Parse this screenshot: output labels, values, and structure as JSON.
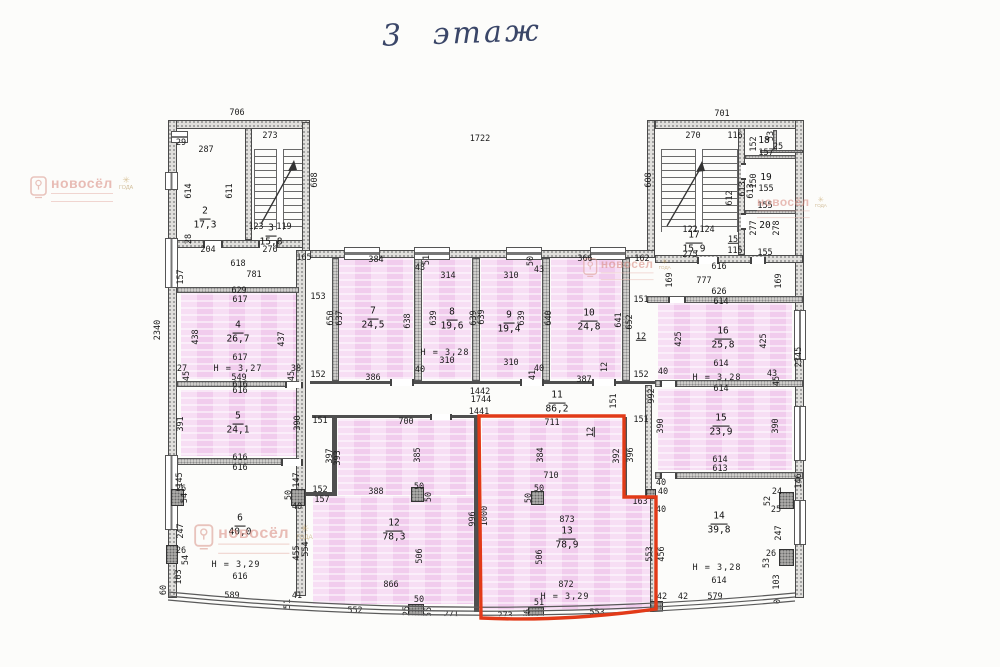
{
  "page": {
    "title_handwritten": "3 этаж"
  },
  "watermark": {
    "brand": "новосёл",
    "badge": "ГОДА"
  },
  "rooms": [
    {
      "num": "2",
      "area": "17,3",
      "x": 205,
      "y": 219
    },
    {
      "num": "3",
      "area": "15,8",
      "x": 271,
      "y": 236
    },
    {
      "num": "4",
      "area": "26,7",
      "x": 238,
      "y": 333
    },
    {
      "num": "5",
      "area": "24,1",
      "x": 238,
      "y": 424
    },
    {
      "num": "6",
      "area": "40,0",
      "x": 240,
      "y": 526
    },
    {
      "num": "7",
      "area": "24,5",
      "x": 373,
      "y": 319
    },
    {
      "num": "8",
      "area": "19,6",
      "x": 452,
      "y": 320
    },
    {
      "num": "9",
      "area": "19,4",
      "x": 509,
      "y": 323
    },
    {
      "num": "10",
      "area": "24,8",
      "x": 589,
      "y": 321
    },
    {
      "num": "11",
      "area": "86,2",
      "x": 557,
      "y": 403
    },
    {
      "num": "12",
      "area": "78,3",
      "x": 394,
      "y": 531
    },
    {
      "num": "13",
      "area": "78,9",
      "x": 567,
      "y": 539
    },
    {
      "num": "14",
      "area": "39,8",
      "x": 719,
      "y": 524
    },
    {
      "num": "15",
      "area": "23,9",
      "x": 721,
      "y": 426
    },
    {
      "num": "16",
      "area": "25,8",
      "x": 723,
      "y": 339
    },
    {
      "num": "17",
      "area": "15,9",
      "x": 694,
      "y": 243
    },
    {
      "num": "18",
      "area": "",
      "x": 764,
      "y": 142
    },
    {
      "num": "19",
      "area": "",
      "x": 766,
      "y": 179
    },
    {
      "num": "20",
      "area": "",
      "x": 765,
      "y": 227
    }
  ],
  "heights": [
    {
      "t": "H = 3,27",
      "x": 238,
      "y": 369
    },
    {
      "t": "H = 3,29",
      "x": 236,
      "y": 565
    },
    {
      "t": "H = 3,28",
      "x": 445,
      "y": 353
    },
    {
      "t": "H = 3,28",
      "x": 717,
      "y": 378
    },
    {
      "t": "H = 3,29",
      "x": 565,
      "y": 597
    },
    {
      "t": "H = 3,28",
      "x": 717,
      "y": 568
    }
  ],
  "dims": [
    {
      "t": "706",
      "x": 237,
      "y": 113
    },
    {
      "t": "273",
      "x": 270,
      "y": 136
    },
    {
      "t": "701",
      "x": 722,
      "y": 114
    },
    {
      "t": "270",
      "x": 693,
      "y": 136
    },
    {
      "t": "116",
      "x": 735,
      "y": 136
    },
    {
      "t": "1722",
      "x": 480,
      "y": 139
    },
    {
      "t": "608",
      "x": 315,
      "y": 180,
      "r": 1
    },
    {
      "t": "608",
      "x": 649,
      "y": 180,
      "r": 1
    },
    {
      "t": "2340",
      "x": 158,
      "y": 330,
      "r": 1
    },
    {
      "t": "2345",
      "x": 799,
      "y": 357,
      "r": 1
    },
    {
      "t": "29",
      "x": 181,
      "y": 143
    },
    {
      "t": "287",
      "x": 206,
      "y": 150
    },
    {
      "t": "614",
      "x": 189,
      "y": 191,
      "r": 1
    },
    {
      "t": "611",
      "x": 230,
      "y": 191,
      "r": 1
    },
    {
      "t": "123",
      "x": 256,
      "y": 227
    },
    {
      "t": "119",
      "x": 284,
      "y": 227
    },
    {
      "t": "28",
      "x": 189,
      "y": 239,
      "r": 1
    },
    {
      "t": "204",
      "x": 208,
      "y": 250
    },
    {
      "t": "276",
      "x": 270,
      "y": 250
    },
    {
      "t": "165",
      "x": 304,
      "y": 258
    },
    {
      "t": "618",
      "x": 238,
      "y": 264
    },
    {
      "t": "781",
      "x": 254,
      "y": 275
    },
    {
      "t": "157",
      "x": 181,
      "y": 277,
      "r": 1
    },
    {
      "t": "629",
      "x": 239,
      "y": 291
    },
    {
      "t": "617",
      "x": 240,
      "y": 300
    },
    {
      "t": "153",
      "x": 318,
      "y": 297
    },
    {
      "t": "438",
      "x": 196,
      "y": 337,
      "r": 1
    },
    {
      "t": "437",
      "x": 282,
      "y": 339,
      "r": 1
    },
    {
      "t": "617",
      "x": 240,
      "y": 358
    },
    {
      "t": "27",
      "x": 182,
      "y": 369
    },
    {
      "t": "45",
      "x": 187,
      "y": 376,
      "r": 1
    },
    {
      "t": "549",
      "x": 239,
      "y": 378
    },
    {
      "t": "38",
      "x": 296,
      "y": 369
    },
    {
      "t": "45",
      "x": 292,
      "y": 376,
      "r": 1
    },
    {
      "t": "616",
      "x": 240,
      "y": 385
    },
    {
      "t": "616",
      "x": 240,
      "y": 391
    },
    {
      "t": "391",
      "x": 181,
      "y": 424,
      "r": 1
    },
    {
      "t": "390",
      "x": 298,
      "y": 423,
      "r": 1
    },
    {
      "t": "616",
      "x": 240,
      "y": 458
    },
    {
      "t": "616",
      "x": 240,
      "y": 468
    },
    {
      "t": "145",
      "x": 180,
      "y": 480,
      "r": 1
    },
    {
      "t": "147",
      "x": 297,
      "y": 480,
      "r": 1
    },
    {
      "t": "26",
      "x": 181,
      "y": 489
    },
    {
      "t": "54",
      "x": 185,
      "y": 498,
      "r": 1
    },
    {
      "t": "50",
      "x": 289,
      "y": 495,
      "r": 1
    },
    {
      "t": "40",
      "x": 297,
      "y": 507
    },
    {
      "t": "247",
      "x": 181,
      "y": 531,
      "r": 1
    },
    {
      "t": "455",
      "x": 297,
      "y": 553,
      "r": 1
    },
    {
      "t": "554",
      "x": 306,
      "y": 549,
      "r": 1
    },
    {
      "t": "26",
      "x": 181,
      "y": 551
    },
    {
      "t": "54",
      "x": 186,
      "y": 560,
      "r": 1
    },
    {
      "t": "103",
      "x": 179,
      "y": 577,
      "r": 1
    },
    {
      "t": "616",
      "x": 240,
      "y": 577
    },
    {
      "t": "589",
      "x": 232,
      "y": 596
    },
    {
      "t": "60",
      "x": 164,
      "y": 590,
      "r": 1
    },
    {
      "t": "41",
      "x": 297,
      "y": 596
    },
    {
      "t": "51",
      "x": 288,
      "y": 604,
      "r": 1
    },
    {
      "t": "152",
      "x": 318,
      "y": 375
    },
    {
      "t": "384",
      "x": 376,
      "y": 260
    },
    {
      "t": "43",
      "x": 420,
      "y": 268
    },
    {
      "t": "51",
      "x": 427,
      "y": 260,
      "r": 1
    },
    {
      "t": "314",
      "x": 448,
      "y": 276
    },
    {
      "t": "50",
      "x": 531,
      "y": 261,
      "r": 1
    },
    {
      "t": "43",
      "x": 539,
      "y": 270
    },
    {
      "t": "310",
      "x": 511,
      "y": 276
    },
    {
      "t": "366",
      "x": 585,
      "y": 259
    },
    {
      "t": "162",
      "x": 642,
      "y": 259
    },
    {
      "t": "650",
      "x": 331,
      "y": 318,
      "r": 1
    },
    {
      "t": "637",
      "x": 340,
      "y": 318,
      "r": 1
    },
    {
      "t": "638",
      "x": 408,
      "y": 321,
      "r": 1
    },
    {
      "t": "639",
      "x": 434,
      "y": 318,
      "r": 1
    },
    {
      "t": "639",
      "x": 474,
      "y": 318,
      "r": 1
    },
    {
      "t": "639",
      "x": 482,
      "y": 317,
      "r": 1
    },
    {
      "t": "639",
      "x": 522,
      "y": 318,
      "r": 1
    },
    {
      "t": "640",
      "x": 549,
      "y": 318,
      "r": 1
    },
    {
      "t": "641",
      "x": 619,
      "y": 320,
      "r": 1
    },
    {
      "t": "652",
      "x": 630,
      "y": 322,
      "r": 1
    },
    {
      "t": "151",
      "x": 641,
      "y": 300
    },
    {
      "t": "12",
      "x": 641,
      "y": 337,
      "u": 1
    },
    {
      "t": "310",
      "x": 447,
      "y": 361
    },
    {
      "t": "310",
      "x": 511,
      "y": 363
    },
    {
      "t": "386",
      "x": 373,
      "y": 378
    },
    {
      "t": "40",
      "x": 420,
      "y": 370
    },
    {
      "t": "40",
      "x": 539,
      "y": 369
    },
    {
      "t": "41",
      "x": 533,
      "y": 375,
      "r": 1
    },
    {
      "t": "387",
      "x": 584,
      "y": 380
    },
    {
      "t": "12",
      "x": 605,
      "y": 367,
      "r": 1
    },
    {
      "t": "152",
      "x": 641,
      "y": 375
    },
    {
      "t": "1442",
      "x": 480,
      "y": 392
    },
    {
      "t": "1744",
      "x": 481,
      "y": 400
    },
    {
      "t": "1441",
      "x": 479,
      "y": 412
    },
    {
      "t": "151",
      "x": 614,
      "y": 401,
      "r": 1
    },
    {
      "t": "992",
      "x": 652,
      "y": 396,
      "r": 1
    },
    {
      "t": "151",
      "x": 320,
      "y": 421
    },
    {
      "t": "700",
      "x": 406,
      "y": 422
    },
    {
      "t": "397",
      "x": 330,
      "y": 456,
      "r": 1
    },
    {
      "t": "393",
      "x": 338,
      "y": 458,
      "r": 1
    },
    {
      "t": "385",
      "x": 418,
      "y": 455,
      "r": 1
    },
    {
      "t": "152",
      "x": 320,
      "y": 490
    },
    {
      "t": "157",
      "x": 322,
      "y": 500
    },
    {
      "t": "388",
      "x": 376,
      "y": 492
    },
    {
      "t": "50",
      "x": 419,
      "y": 487
    },
    {
      "t": "50",
      "x": 429,
      "y": 497,
      "r": 1
    },
    {
      "t": "506",
      "x": 420,
      "y": 556,
      "r": 1
    },
    {
      "t": "866",
      "x": 391,
      "y": 585
    },
    {
      "t": "552",
      "x": 355,
      "y": 611
    },
    {
      "t": "50",
      "x": 419,
      "y": 600
    },
    {
      "t": "25",
      "x": 407,
      "y": 611,
      "r": 1
    },
    {
      "t": "55",
      "x": 429,
      "y": 612,
      "r": 1
    },
    {
      "t": "271",
      "x": 451,
      "y": 615
    },
    {
      "t": "996",
      "x": 473,
      "y": 519,
      "r": 1
    },
    {
      "t": "1000",
      "x": 485,
      "y": 516,
      "r": 1
    },
    {
      "t": "711",
      "x": 552,
      "y": 423
    },
    {
      "t": "12",
      "x": 591,
      "y": 432,
      "r": 1,
      "u": 1
    },
    {
      "t": "151",
      "x": 641,
      "y": 420
    },
    {
      "t": "384",
      "x": 541,
      "y": 455,
      "r": 1
    },
    {
      "t": "392",
      "x": 617,
      "y": 456,
      "r": 1
    },
    {
      "t": "396",
      "x": 631,
      "y": 455,
      "r": 1
    },
    {
      "t": "710",
      "x": 551,
      "y": 476
    },
    {
      "t": "50",
      "x": 539,
      "y": 489
    },
    {
      "t": "50",
      "x": 529,
      "y": 498,
      "r": 1
    },
    {
      "t": "163",
      "x": 640,
      "y": 502
    },
    {
      "t": "40",
      "x": 663,
      "y": 492
    },
    {
      "t": "40",
      "x": 661,
      "y": 510
    },
    {
      "t": "873",
      "x": 567,
      "y": 520
    },
    {
      "t": "506",
      "x": 540,
      "y": 557,
      "r": 1
    },
    {
      "t": "553",
      "x": 650,
      "y": 554,
      "r": 1
    },
    {
      "t": "456",
      "x": 662,
      "y": 554,
      "r": 1
    },
    {
      "t": "872",
      "x": 566,
      "y": 585
    },
    {
      "t": "273",
      "x": 505,
      "y": 616
    },
    {
      "t": "51",
      "x": 539,
      "y": 603
    },
    {
      "t": "56",
      "x": 528,
      "y": 614,
      "r": 1
    },
    {
      "t": "50",
      "x": 536,
      "y": 619,
      "r": 1
    },
    {
      "t": "553",
      "x": 597,
      "y": 613
    },
    {
      "t": "42",
      "x": 662,
      "y": 597
    },
    {
      "t": "122",
      "x": 690,
      "y": 230
    },
    {
      "t": "124",
      "x": 707,
      "y": 230
    },
    {
      "t": "275",
      "x": 690,
      "y": 255
    },
    {
      "t": "15",
      "x": 733,
      "y": 240,
      "u": 1
    },
    {
      "t": "115",
      "x": 735,
      "y": 251
    },
    {
      "t": "616",
      "x": 719,
      "y": 267
    },
    {
      "t": "612",
      "x": 730,
      "y": 198,
      "r": 1
    },
    {
      "t": "613",
      "x": 751,
      "y": 191,
      "r": 1
    },
    {
      "t": "53",
      "x": 771,
      "y": 136,
      "r": 1
    },
    {
      "t": "25",
      "x": 778,
      "y": 147
    },
    {
      "t": "152",
      "x": 754,
      "y": 144,
      "r": 1
    },
    {
      "t": "157",
      "x": 766,
      "y": 153
    },
    {
      "t": "150",
      "x": 754,
      "y": 181,
      "r": 1
    },
    {
      "t": "155",
      "x": 766,
      "y": 189
    },
    {
      "t": "613",
      "x": 743,
      "y": 189,
      "r": 1
    },
    {
      "t": "155",
      "x": 765,
      "y": 206
    },
    {
      "t": "277",
      "x": 754,
      "y": 228,
      "r": 1
    },
    {
      "t": "278",
      "x": 777,
      "y": 228,
      "r": 1
    },
    {
      "t": "155",
      "x": 765,
      "y": 253
    },
    {
      "t": "169",
      "x": 670,
      "y": 280,
      "r": 1
    },
    {
      "t": "777",
      "x": 704,
      "y": 281
    },
    {
      "t": "169",
      "x": 779,
      "y": 281,
      "r": 1
    },
    {
      "t": "626",
      "x": 719,
      "y": 292
    },
    {
      "t": "614",
      "x": 721,
      "y": 302
    },
    {
      "t": "425",
      "x": 679,
      "y": 339,
      "r": 1
    },
    {
      "t": "425",
      "x": 764,
      "y": 341,
      "r": 1
    },
    {
      "t": "614",
      "x": 721,
      "y": 364
    },
    {
      "t": "40",
      "x": 663,
      "y": 372
    },
    {
      "t": "43",
      "x": 772,
      "y": 374
    },
    {
      "t": "45",
      "x": 777,
      "y": 381,
      "r": 1
    },
    {
      "t": "614",
      "x": 721,
      "y": 389
    },
    {
      "t": "390",
      "x": 661,
      "y": 426,
      "r": 1
    },
    {
      "t": "390",
      "x": 776,
      "y": 426,
      "r": 1
    },
    {
      "t": "614",
      "x": 720,
      "y": 460
    },
    {
      "t": "613",
      "x": 720,
      "y": 469
    },
    {
      "t": "146",
      "x": 799,
      "y": 481,
      "r": 1
    },
    {
      "t": "24",
      "x": 777,
      "y": 492
    },
    {
      "t": "40",
      "x": 661,
      "y": 483
    },
    {
      "t": "52",
      "x": 768,
      "y": 501,
      "r": 1
    },
    {
      "t": "25",
      "x": 776,
      "y": 510
    },
    {
      "t": "247",
      "x": 779,
      "y": 533,
      "r": 1
    },
    {
      "t": "26",
      "x": 771,
      "y": 554
    },
    {
      "t": "53",
      "x": 767,
      "y": 563,
      "r": 1
    },
    {
      "t": "103",
      "x": 777,
      "y": 582,
      "r": 1
    },
    {
      "t": "60",
      "x": 778,
      "y": 604,
      "r": 1
    },
    {
      "t": "614",
      "x": 719,
      "y": 581
    },
    {
      "t": "579",
      "x": 715,
      "y": 597
    },
    {
      "t": "42",
      "x": 683,
      "y": 597
    }
  ],
  "watermarks": [
    {
      "x": 30,
      "y": 176,
      "s": 1,
      "icon": true
    },
    {
      "x": 583,
      "y": 258,
      "s": 0.85,
      "icon": true
    },
    {
      "x": 757,
      "y": 196,
      "s": 0.85,
      "icon": false
    },
    {
      "x": 194,
      "y": 524,
      "s": 1.15,
      "icon": true
    },
    {
      "x": 465,
      "y": 622,
      "s": 1,
      "icon": true
    }
  ]
}
